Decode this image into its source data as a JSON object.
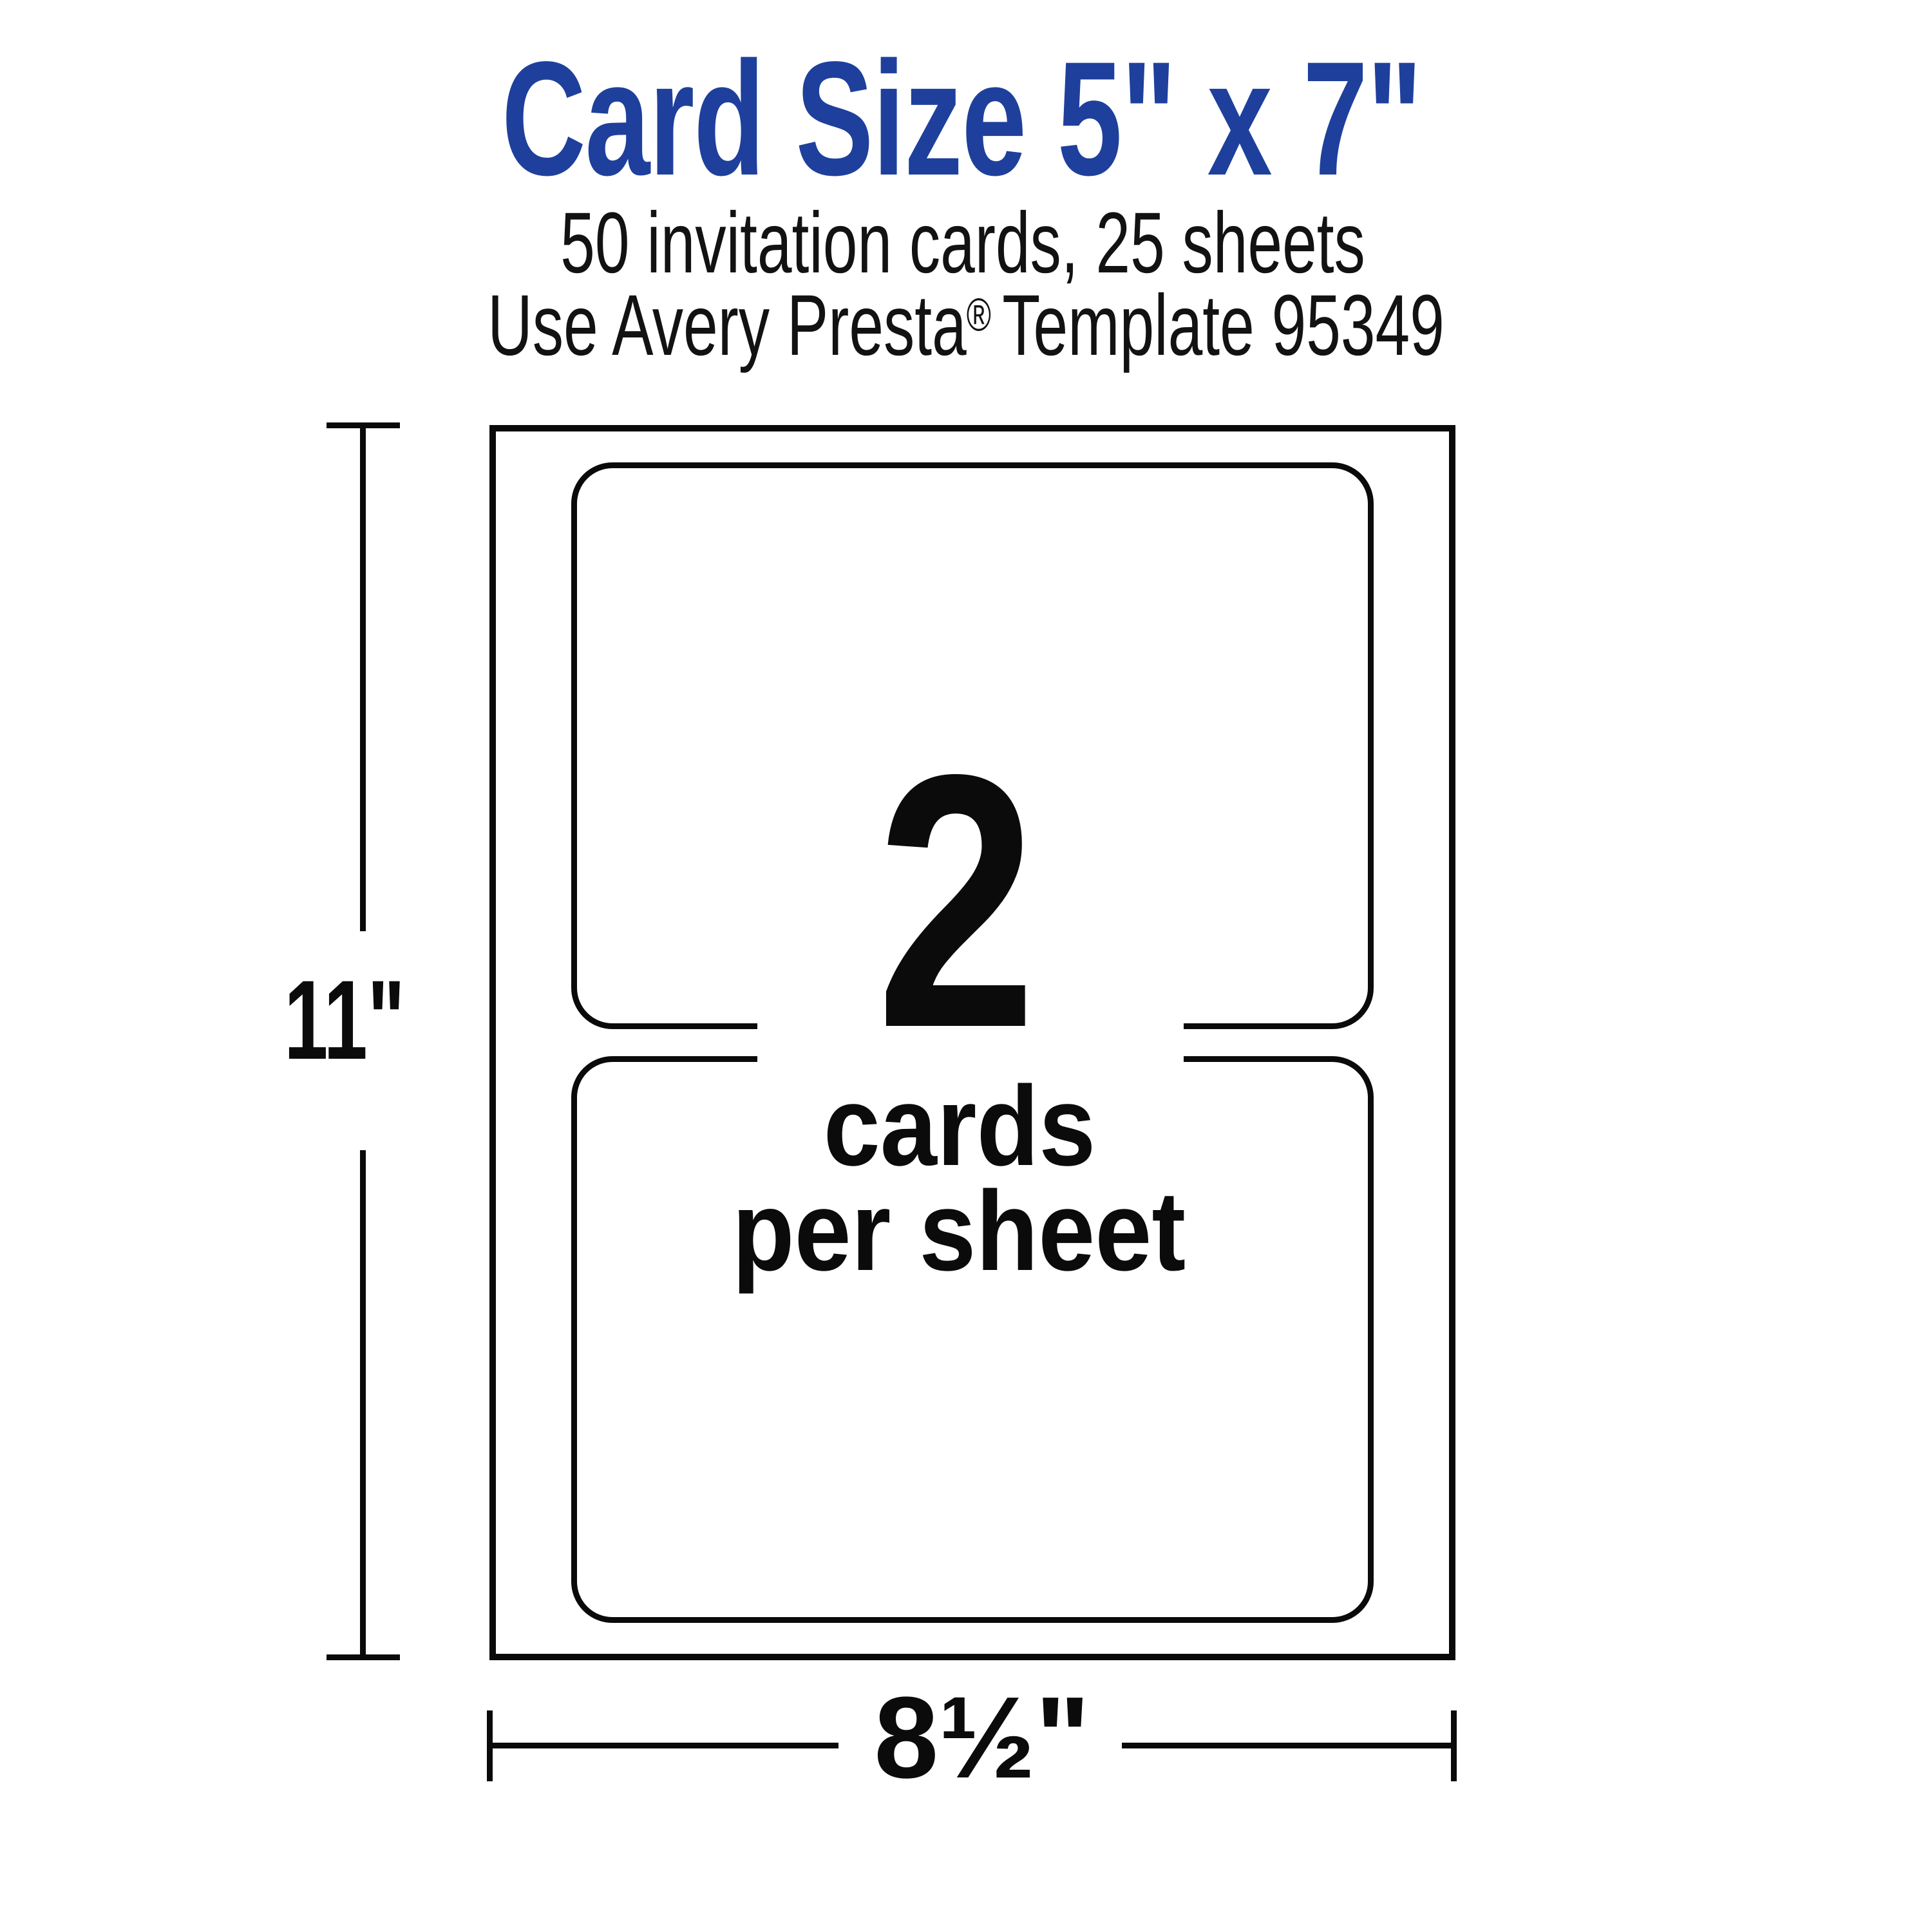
{
  "header": {
    "title": "Card Size 5\" x 7\"",
    "subtitle_line1": "50 invitation cards, 25 sheets",
    "subtitle_line2_prefix": "Use Avery Presta",
    "subtitle_line2_trademark": "®",
    "subtitle_line2_suffix": "Template 95349"
  },
  "diagram": {
    "cards_per_sheet_count": "2",
    "caption_line1": "cards",
    "caption_line2": "per sheet",
    "height_dimension_label": "11\"",
    "width_dimension_label": "8½\"",
    "sheet_width_inches": "8½",
    "sheet_height_inches": "11",
    "card_width_inches": "7",
    "card_height_inches": "5"
  },
  "colors": {
    "title_blue": "#1e409c",
    "diagram_ink": "#0a0a0a",
    "background": "#ffffff"
  }
}
